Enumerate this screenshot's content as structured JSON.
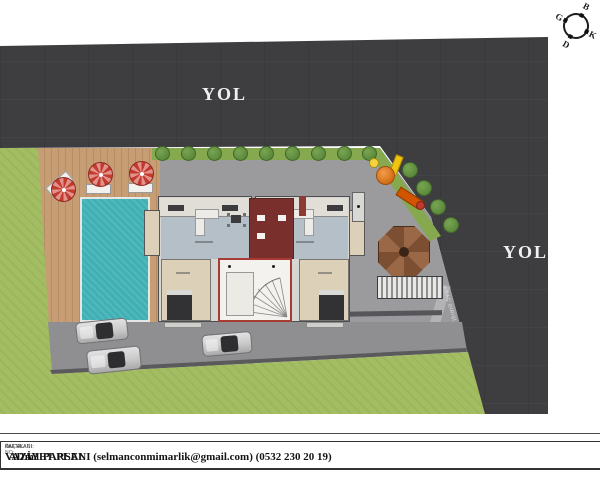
{
  "colors": {
    "road": "#3e3d3f",
    "grass": "#a3bd62",
    "pavement": "#9b9b9d",
    "parking": "#8f8f91",
    "deck": "#c79e74",
    "deck_line": "#b68d66",
    "pool": "#3fb0b4",
    "hedge": "#86a84e",
    "tree": "#5c8a3c",
    "tree_hi": "#79a552",
    "umbrella": "#c23b2e",
    "umbrella_hi": "#e2928a",
    "building": "#d6d6d2",
    "living": "#b4bfc7",
    "bedroom": "#dcd0b9",
    "terrace": "#e0ded6",
    "core_red": "#a63c34",
    "shaft_red": "#79302d",
    "hall": "#f4f2ee",
    "gazebo_a": "#9a6847",
    "gazebo_b": "#7c4f33",
    "pergola_light": "#e8e8e6",
    "pergola_dark": "#8f8f8d",
    "car_body": "#c9c9c9",
    "car_glass": "#2e2e30",
    "label": "#f0f0f0"
  },
  "roads": {
    "top_label": "YOL",
    "right_label": "YOL",
    "driveway_label": "ARAÇ GİRİŞİ"
  },
  "compass": {
    "top": "B",
    "right": "K",
    "bottom": "D",
    "left": "G"
  },
  "title_block": {
    "cells": [
      {
        "label": "",
        "value": "ADA 1 PARSEL"
      },
      {
        "label": "PAFTA ADI:",
        "value": "VAZİYET PLANI (selmanconmimarlik@gmail.com) (0532 230 20 19)"
      },
      {
        "label": "KAT ALANI:",
        "value": "m²"
      },
      {
        "label": "ÖLÇEK:",
        "value": ""
      },
      {
        "label": "PAFTA NO:",
        "value": ""
      }
    ]
  }
}
